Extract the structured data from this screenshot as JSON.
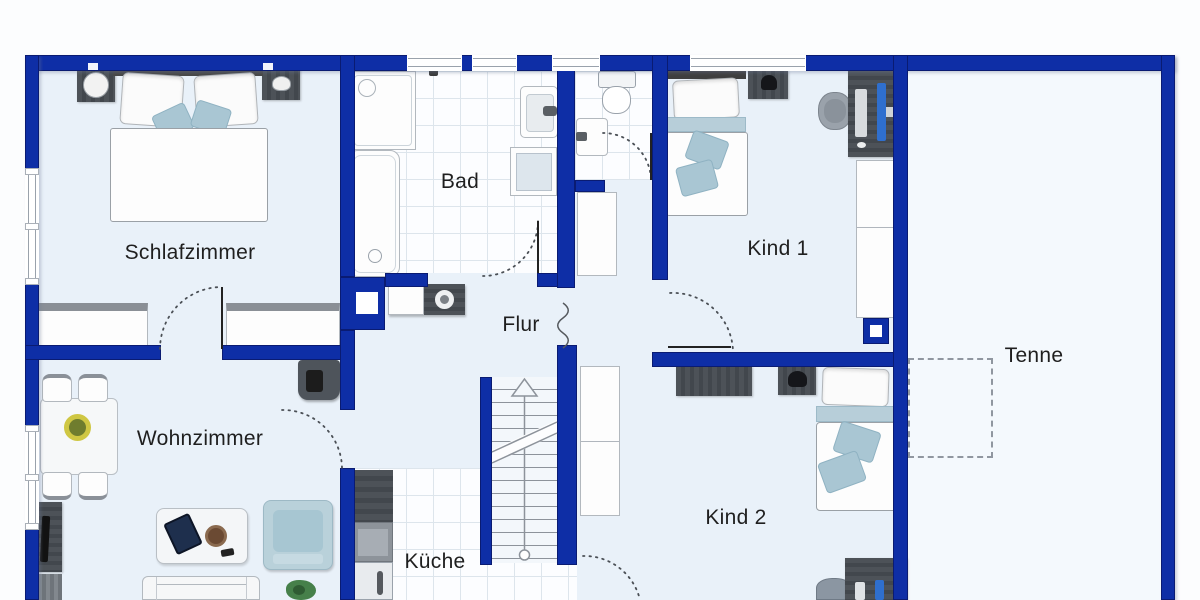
{
  "rooms": {
    "schlafzimmer": {
      "label": "Schlafzimmer"
    },
    "bad": {
      "label": "Bad"
    },
    "flur": {
      "label": "Flur"
    },
    "kind1": {
      "label": "Kind 1"
    },
    "tenne": {
      "label": "Tenne"
    },
    "wohnzimmer": {
      "label": "Wohnzimmer"
    },
    "kueche": {
      "label": "Küche"
    },
    "kind2": {
      "label": "Kind 2"
    }
  },
  "colors": {
    "wall": "#0e2ea6",
    "wall_edge": "#0a1b72",
    "floor": "#e9f1f9",
    "floor_tenne": "#f4f9fd",
    "tile": "#fcfdff",
    "tile_line": "#dde5ec",
    "accent_textile": "#a9c6d3",
    "furniture_dark": "#4a4f55",
    "monitor_blue": "#2f6fce"
  }
}
